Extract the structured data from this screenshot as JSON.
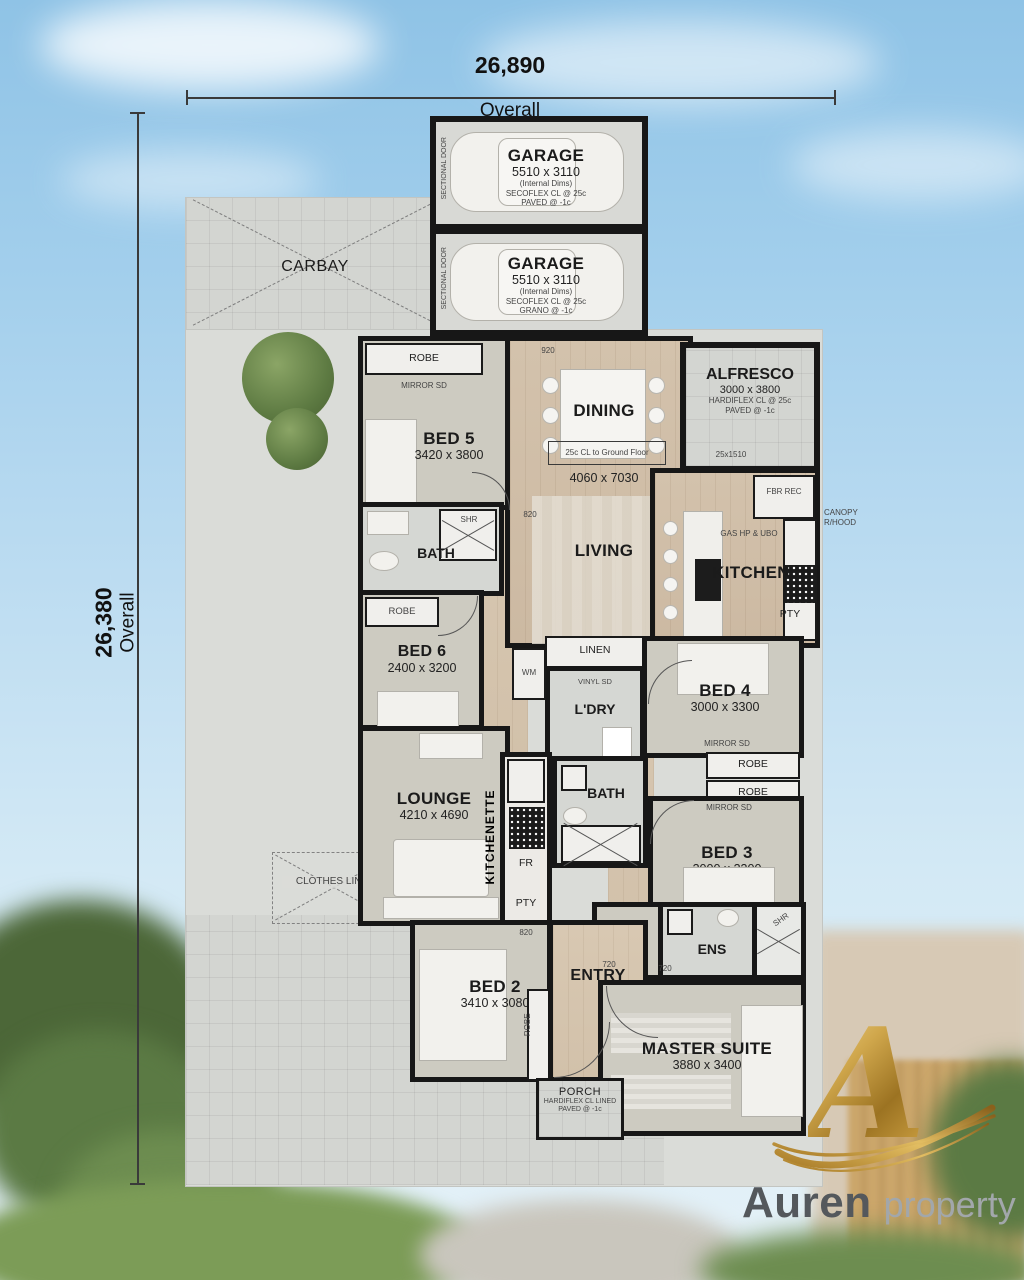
{
  "dimensions": {
    "top_value": "26,890",
    "top_label": "Overall",
    "left_value": "26,380",
    "left_label": "Overall"
  },
  "site": {
    "carbay": "CARBAY",
    "clothes_line": "CLOTHES LINE"
  },
  "garage1": {
    "name": "GARAGE",
    "dims": "5510 x 3110",
    "note1": "(Internal Dims)",
    "note2": "SECOFLEX CL @ 25c",
    "note3": "PAVED @ -1c",
    "door": "SECTIONAL DOOR"
  },
  "garage2": {
    "name": "GARAGE",
    "dims": "5510 x 3110",
    "note1": "(Internal Dims)",
    "note2": "SECOFLEX CL @ 25c",
    "note3": "GRANO @ -1c",
    "door": "SECTIONAL DOOR"
  },
  "rooms": {
    "alfresco": {
      "name": "ALFRESCO",
      "dims": "3000 x 3800",
      "note1": "HARDIFLEX CL @ 25c",
      "note2": "PAVED @ -1c",
      "window": "25x1510"
    },
    "bed5": {
      "name": "BED 5",
      "dims": "3420 x 3800",
      "robe": "ROBE",
      "mirror": "MIRROR SD"
    },
    "dining": {
      "name": "DINING"
    },
    "living": {
      "name": "LIVING",
      "dims": "4060 x 7030",
      "note": "25c CL to Ground Floor"
    },
    "kitchen": {
      "name": "KITCHEN",
      "fridge": "FBR REC",
      "canopy": "CANOPY R/HOOD",
      "gas": "GAS HP & UBO",
      "pantry": "PTY"
    },
    "bath1": {
      "name": "BATH",
      "shower": "SHR"
    },
    "bed6": {
      "name": "BED 6",
      "dims": "2400 x 3200",
      "robe": "ROBE"
    },
    "laundry": {
      "name": "L'DRY",
      "linen": "LINEN",
      "vinyl": "VINYL SD",
      "wm": "WM"
    },
    "bed4": {
      "name": "BED 4",
      "dims": "3000 x 3300",
      "mirror": "MIRROR SD",
      "robe1": "ROBE",
      "robe2": "ROBE"
    },
    "lounge": {
      "name": "LOUNGE",
      "dims": "4210 x 4690"
    },
    "kitchenette": {
      "name": "KITCHENETTE",
      "fridge": "FR",
      "pantry": "PTY"
    },
    "bath2": {
      "name": "BATH"
    },
    "bed3": {
      "name": "BED 3",
      "dims": "3000 x 3300",
      "mirror": "MIRROR SD"
    },
    "wir": {
      "name": "WIR"
    },
    "ens": {
      "name": "ENS",
      "shower": "SHR"
    },
    "bed2": {
      "name": "BED 2",
      "dims": "3410 x 3080",
      "robe": "ROBE"
    },
    "entry": {
      "name": "ENTRY"
    },
    "master": {
      "name": "MASTER SUITE",
      "dims": "3880 x 3400"
    },
    "porch": {
      "name": "PORCH",
      "note1": "HARDIFLEX CL LINED",
      "note2": "PAVED @ -1c"
    }
  },
  "door_labels": {
    "d820": "820",
    "d720": "720",
    "d920": "920"
  },
  "logo": {
    "monogram": "A",
    "brand": "Auren",
    "suffix": "property group",
    "gold": "#c79b3e",
    "text_dark": "#54585c",
    "text_light": "#a2a7ab"
  }
}
